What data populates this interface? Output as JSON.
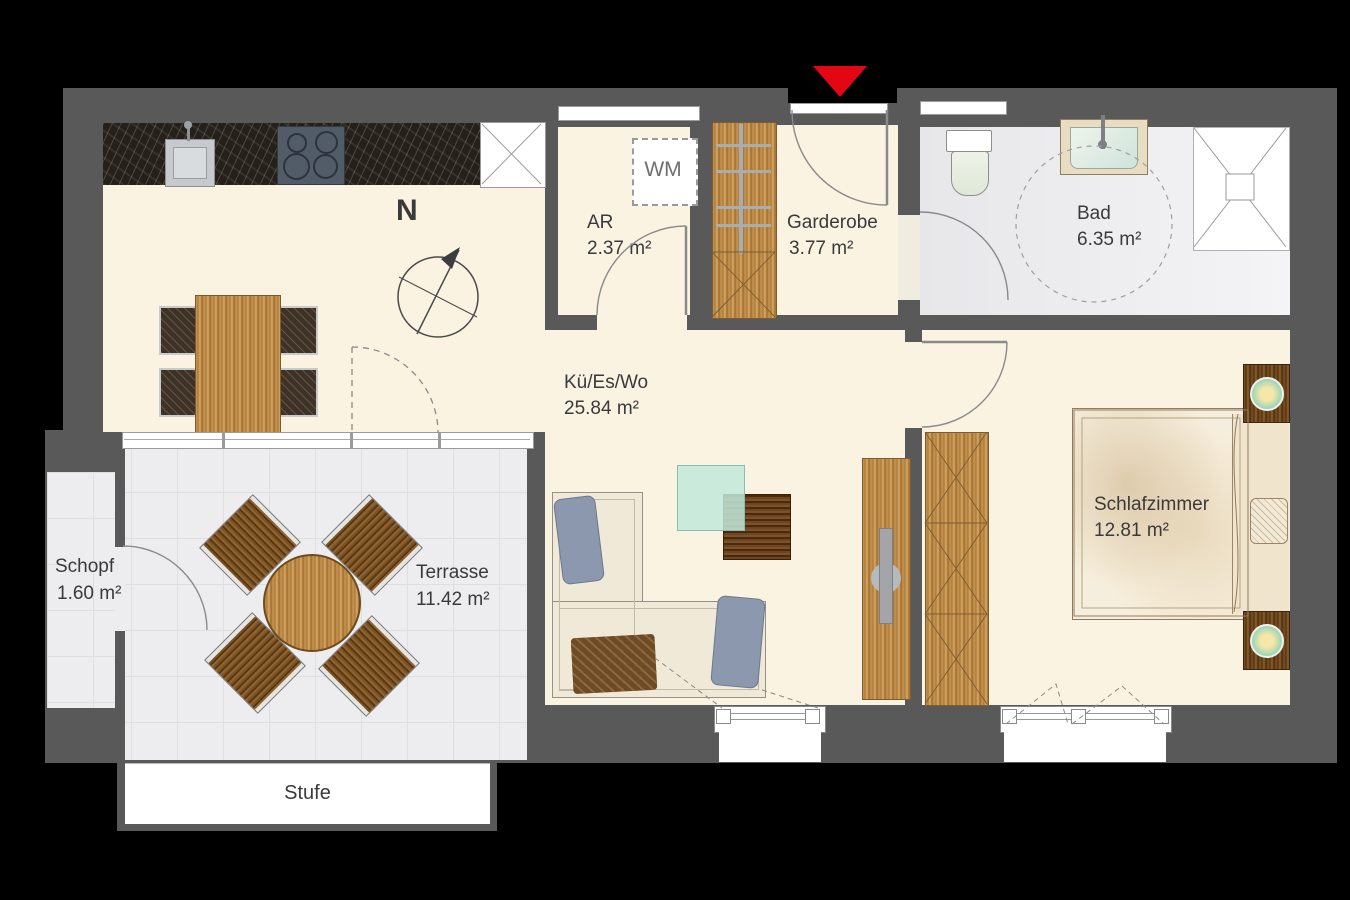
{
  "rooms": [
    {
      "name": "AR",
      "area": "2.37 m²"
    },
    {
      "name": "Garderobe",
      "area": "3.77 m²"
    },
    {
      "name": "Bad",
      "area": "6.35 m²"
    },
    {
      "name": "Kü/Es/Wo",
      "area": "25.84 m²"
    },
    {
      "name": "Schlafzimmer",
      "area": "12.81 m²"
    },
    {
      "name": "Terrasse",
      "area": "11.42 m²"
    },
    {
      "name": "Schopf",
      "area": "1.60 m²"
    }
  ],
  "annotations": {
    "step": "Stufe",
    "washing_machine": "WM",
    "north": "N"
  },
  "colors": {
    "entrance_arrow": "#e30613",
    "walls": "#595959",
    "living_floor": "#faf3e1",
    "wet_floor": "#ededef",
    "wood_light": "#b9863f",
    "wood_dark": "#5c3c1c",
    "background": "#000000"
  }
}
